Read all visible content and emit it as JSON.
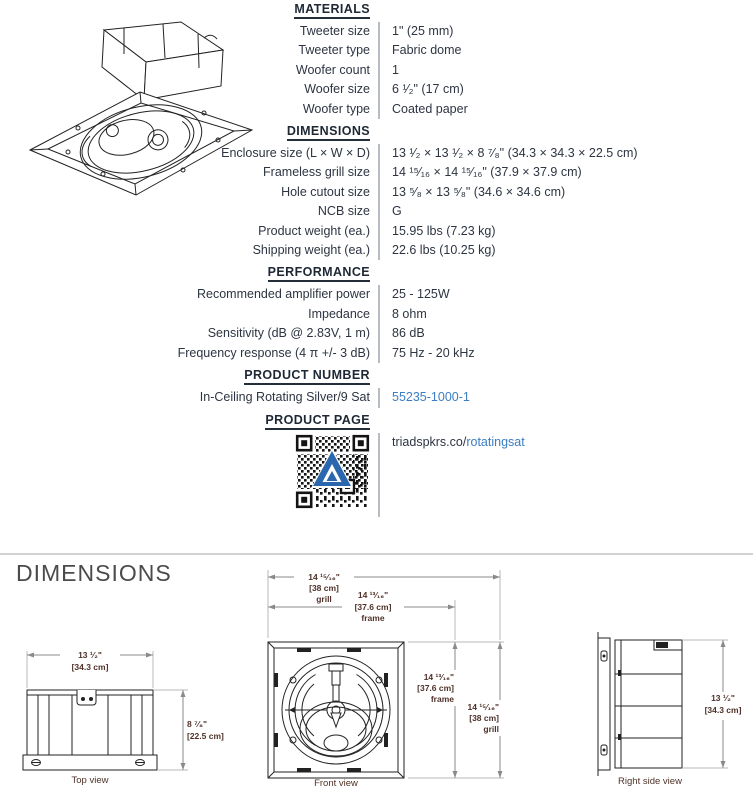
{
  "specs": {
    "materials": {
      "heading": "MATERIALS",
      "rows": [
        {
          "label": "Tweeter size",
          "value": "1\" (25 mm)"
        },
        {
          "label": "Tweeter type",
          "value": "Fabric dome"
        },
        {
          "label": "Woofer count",
          "value": "1"
        },
        {
          "label": "Woofer size",
          "value": "6 ¹⁄₂\" (17 cm)"
        },
        {
          "label": "Woofer type",
          "value": "Coated paper"
        }
      ]
    },
    "dimensions": {
      "heading": "DIMENSIONS",
      "rows": [
        {
          "label": "Enclosure size (L × W × D)",
          "value": "13 ¹⁄₂  ×  13 ¹⁄₂  ×  8 ⁷⁄₈\" (34.3 × 34.3 × 22.5 cm)"
        },
        {
          "label": "Frameless grill size",
          "value": "14 ¹⁵⁄₁₆  ×  14 ¹⁵⁄₁₆\" (37.9 × 37.9 cm)"
        },
        {
          "label": "Hole cutout size",
          "value": "13 ⁵⁄₈  ×  13 ⁵⁄₈\" (34.6 × 34.6 cm)"
        },
        {
          "label": "NCB size",
          "value": "G"
        },
        {
          "label": "Product weight (ea.)",
          "value": "15.95 lbs (7.23 kg)"
        },
        {
          "label": "Shipping weight (ea.)",
          "value": "22.6 lbs (10.25 kg)"
        }
      ]
    },
    "performance": {
      "heading": "PERFORMANCE",
      "rows": [
        {
          "label": "Recommended amplifier power",
          "value": "25 - 125W"
        },
        {
          "label": "Impedance",
          "value": "8 ohm"
        },
        {
          "label": "Sensitivity (dB @ 2.83V, 1 m)",
          "value": "86 dB"
        },
        {
          "label": "Frequency response (4 π +/- 3 dB)",
          "value": "75 Hz - 20 kHz"
        }
      ]
    },
    "product_number": {
      "heading": "PRODUCT NUMBER",
      "label": "In-Ceiling Rotating Silver/9 Sat",
      "value": "55235-1000-1"
    },
    "product_page": {
      "heading": "PRODUCT PAGE",
      "url_prefix": "triadspkrs.co/",
      "url_highlight": "rotatingsat"
    }
  },
  "drawings": {
    "section_title": "DIMENSIONS",
    "top_view": {
      "caption": "Top view",
      "width_in": "13 ¹⁄₂\"",
      "width_cm": "[34.3 cm]",
      "depth_in": "8 ⁷⁄₈\"",
      "depth_cm": "[22.5 cm]"
    },
    "front_view": {
      "caption": "Front view",
      "grill_w_in": "14 ¹⁵⁄₁₆\"",
      "grill_w_cm": "[38 cm]",
      "grill_w_label": "grill",
      "frame_w_in": "14 ¹³⁄₁₆\"",
      "frame_w_cm": "[37.6 cm]",
      "frame_w_label": "frame",
      "frame_h_in": "14 ¹³⁄₁₆\"",
      "frame_h_cm": "[37.6 cm]",
      "frame_h_label": "frame",
      "grill_h_in": "14 ¹⁵⁄₁₆\"",
      "grill_h_cm": "[38 cm]",
      "grill_h_label": "grill"
    },
    "right_view": {
      "caption": "Right side view",
      "height_in": "13 ¹⁄₂\"",
      "height_cm": "[34.3 cm]"
    }
  },
  "colors": {
    "link": "#3b7dc4",
    "heading_text": "#1e2835",
    "body_text": "#2d3542",
    "dim_label": "#4e3129",
    "accent_blue": "#2b67ac"
  }
}
